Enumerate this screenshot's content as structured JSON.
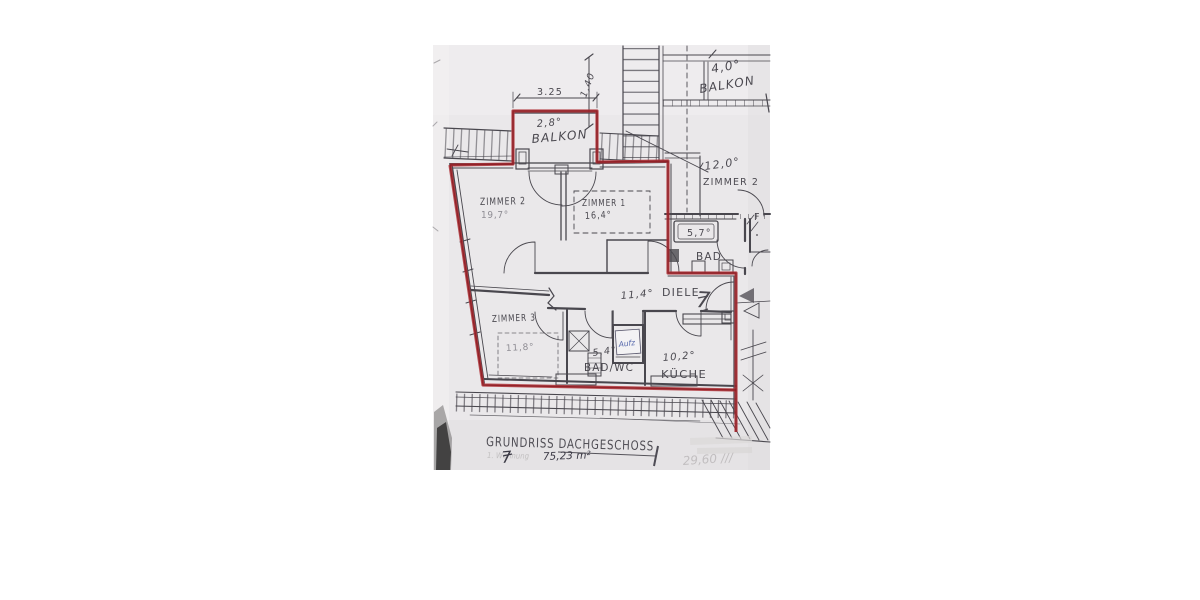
{
  "footer": {
    "title": "GRUNDRISS DACHGESCHOSS",
    "unit_label_faint": "1. Wohnung",
    "unit_number": "7",
    "area_total": "75,23 m²",
    "faded_note": "29,60 ///"
  },
  "rooms": {
    "balkon_top": {
      "area": "2,8°",
      "name": "BALKON"
    },
    "balkon_right": {
      "area": "4,0°",
      "name": "BALKON"
    },
    "zimmer1": {
      "name": "ZIMMER 1",
      "area": "16,4°"
    },
    "zimmer2": {
      "name": "ZIMMER 2",
      "area": "19,7°"
    },
    "zimmer3": {
      "name": "ZIMMER 3",
      "area": "11,8°"
    },
    "neighbor_zimmer2": {
      "area": "12,0°",
      "name": "ZIMMER 2"
    },
    "bad": {
      "area": "5,7°",
      "name": "BAD"
    },
    "bad_wc": {
      "area": "5,4°",
      "name": "BAD/WC"
    },
    "kueche": {
      "area": "10,2°",
      "name": "KÜCHE"
    },
    "diele": {
      "area": "11,4°",
      "name": "DIELE",
      "unit_number": "7"
    },
    "aufzug": {
      "label": "Aufz"
    }
  },
  "dimensions": {
    "balkon_width": "3.25",
    "stair_run": "1,40",
    "door_mark": "F"
  },
  "colors": {
    "paper": "#eae8ea",
    "pencil": "#49474e",
    "red_marker": "#a8262c",
    "blue_ink": "#5567ab",
    "shadow": "#3b393a",
    "faded_ink": "#b9b6b7"
  }
}
